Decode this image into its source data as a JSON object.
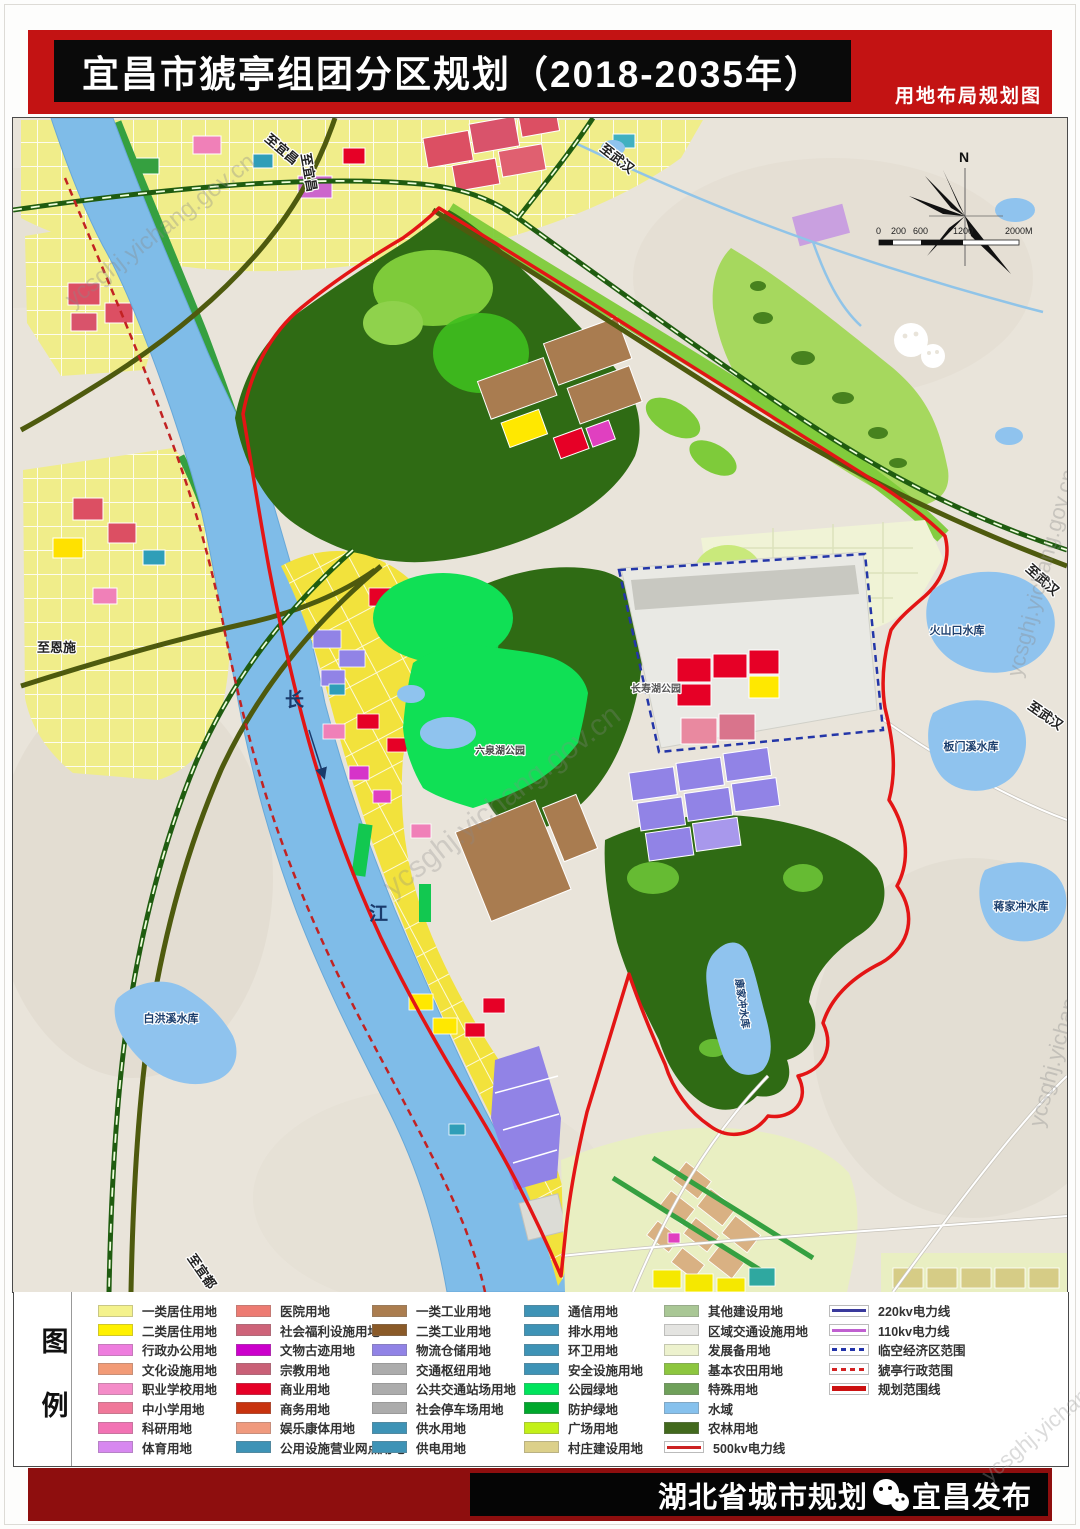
{
  "header": {
    "title": "宜昌市猇亭组团分区规划（2018-2035年）",
    "subtitle": "用地布局规划图"
  },
  "colors": {
    "header_band_red": "#C31313",
    "footer_band_red": "#8E0E0E",
    "planning_boundary_red": "#E31515",
    "river_blue": "#7FBCE8",
    "forest_green": "#2F6B14"
  },
  "map": {
    "compass": "N",
    "scale_ticks": [
      "0",
      "200",
      "600",
      "1200",
      "2000M"
    ],
    "watermark": "ycsghj.yichang.gov.cn",
    "labels": {
      "to_yichang": "至宜昌",
      "to_wuhan": "至武汉",
      "to_enshi": "至恩施",
      "to_yidu": "至宜都",
      "changjiang_1": "长",
      "changjiang_2": "江",
      "res_huoshankou": "火山口水库",
      "res_banmenxi": "板门溪水库",
      "res_jiangjiachong": "蒋家冲水库",
      "res_baihongxi": "白洪溪水库",
      "res_kangjiachong": "康家冲水库",
      "park_changshouhu": "长寿湖公园",
      "park_liuquanhu": "六泉湖公园"
    }
  },
  "legend": {
    "title_chars": [
      "图",
      "例"
    ],
    "columns": [
      {
        "items": [
          {
            "label": "一类居住用地",
            "color": "#F4F28C",
            "type": "fill"
          },
          {
            "label": "二类居住用地",
            "color": "#FFF100",
            "type": "fill"
          },
          {
            "label": "行政办公用地",
            "color": "#EE7DDE",
            "type": "fill"
          },
          {
            "label": "文化设施用地",
            "color": "#F29B77",
            "type": "fill"
          },
          {
            "label": "职业学校用地",
            "color": "#F48CC8",
            "type": "fill"
          },
          {
            "label": "中小学用地",
            "color": "#F0789A",
            "type": "fill"
          },
          {
            "label": "科研用地",
            "color": "#F273B4",
            "type": "fill"
          },
          {
            "label": "体育用地",
            "color": "#D788F0",
            "type": "fill"
          }
        ]
      },
      {
        "items": [
          {
            "label": "医院用地",
            "color": "#ED7B72",
            "type": "fill"
          },
          {
            "label": "社会福利设施用地",
            "color": "#CE6379",
            "type": "fill"
          },
          {
            "label": "文物古迹用地",
            "color": "#CC00CC",
            "type": "fill"
          },
          {
            "label": "宗教用地",
            "color": "#C96077",
            "type": "fill"
          },
          {
            "label": "商业用地",
            "color": "#E60026",
            "type": "fill"
          },
          {
            "label": "商务用地",
            "color": "#C8330F",
            "type": "fill"
          },
          {
            "label": "娱乐康体用地",
            "color": "#F09A7E",
            "type": "fill"
          },
          {
            "label": "公用设施营业网点用地",
            "color": "#3E93B6",
            "type": "fill"
          }
        ]
      },
      {
        "items": [
          {
            "label": "一类工业用地",
            "color": "#AB7D4F",
            "type": "fill"
          },
          {
            "label": "二类工业用地",
            "color": "#8A5A28",
            "type": "fill"
          },
          {
            "label": "物流仓储用地",
            "color": "#9183E6",
            "type": "fill"
          },
          {
            "label": "交通枢纽用地",
            "color": "#ACACAC",
            "type": "fill"
          },
          {
            "label": "公共交通站场用地",
            "color": "#ACACAC",
            "type": "fill"
          },
          {
            "label": "社会停车场用地",
            "color": "#ACACAC",
            "type": "fill"
          },
          {
            "label": "供水用地",
            "color": "#3E93B6",
            "type": "fill"
          },
          {
            "label": "供电用地",
            "color": "#3E93B6",
            "type": "fill"
          }
        ]
      },
      {
        "items": [
          {
            "label": "通信用地",
            "color": "#3E93B6",
            "type": "fill"
          },
          {
            "label": "排水用地",
            "color": "#3E93B6",
            "type": "fill"
          },
          {
            "label": "环卫用地",
            "color": "#3E93B6",
            "type": "fill"
          },
          {
            "label": "安全设施用地",
            "color": "#3E93B6",
            "type": "fill"
          },
          {
            "label": "公园绿地",
            "color": "#00E45C",
            "type": "fill"
          },
          {
            "label": "防护绿地",
            "color": "#00A82D",
            "type": "fill"
          },
          {
            "label": "广场用地",
            "color": "#C3F018",
            "type": "fill"
          },
          {
            "label": "村庄建设用地",
            "color": "#DCD08A",
            "type": "fill"
          }
        ]
      },
      {
        "items": [
          {
            "label": "其他建设用地",
            "color": "#A9C795",
            "type": "fill"
          },
          {
            "label": "区域交通设施用地",
            "color": "#E4E4E1",
            "type": "fill"
          },
          {
            "label": "发展备用地",
            "color": "#EDF2CE",
            "type": "fill"
          },
          {
            "label": "基本农田用地",
            "color": "#8DC63F",
            "type": "fill"
          },
          {
            "label": "特殊用地",
            "color": "#6FA05A",
            "type": "fill"
          },
          {
            "label": "水域",
            "color": "#86C1ED",
            "type": "fill"
          },
          {
            "label": "农林用地",
            "color": "#42691D",
            "type": "fill"
          },
          {
            "label": "500kv电力线",
            "color": "#CC2222",
            "type": "line"
          }
        ]
      },
      {
        "items": [
          {
            "label": "220kv电力线",
            "color": "#3A3A9C",
            "type": "line"
          },
          {
            "label": "110kv电力线",
            "color": "#C060D0",
            "type": "line"
          },
          {
            "label": "临空经济区范围",
            "color": "#2233AA",
            "type": "dash"
          },
          {
            "label": "猇亭行政范围",
            "color": "#D42222",
            "type": "dash"
          },
          {
            "label": "规划范围线",
            "color": "#CC1111",
            "type": "thick"
          }
        ]
      }
    ]
  },
  "footer": {
    "institute": "湖北省城市规划",
    "publisher": "宜昌发布"
  }
}
